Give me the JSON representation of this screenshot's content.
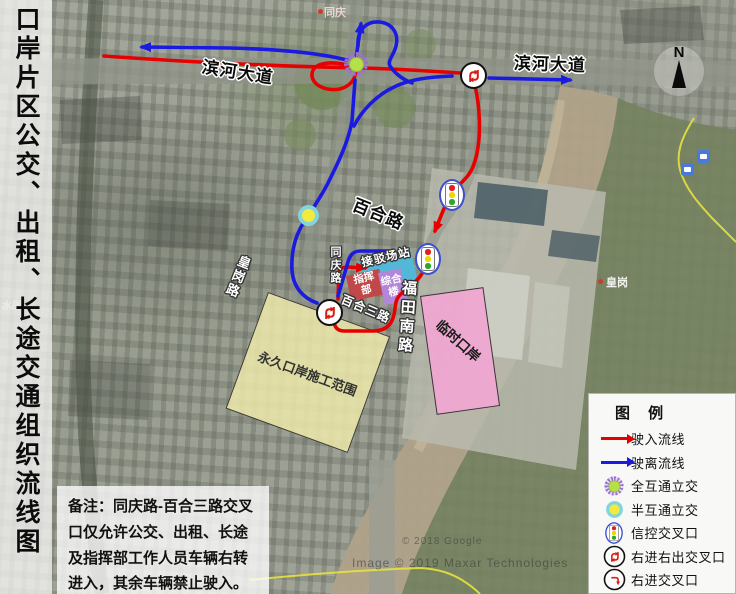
{
  "title": "口岸片区公交、出租、长途交通组织流线图",
  "note": "备注：同庆路-百合三路交叉口仅允许公交、出租、长途及指挥部工作人员车辆右转进入，其余车辆禁止驶入。",
  "compass": "N",
  "legend": {
    "title": "图 例",
    "items": [
      {
        "icon": "entry-flow-arrow",
        "label": "驶入流线"
      },
      {
        "icon": "exit-flow-arrow",
        "label": "驶离流线"
      },
      {
        "icon": "full-interchange",
        "label": "全互通立交"
      },
      {
        "icon": "half-interchange",
        "label": "半互通立交"
      },
      {
        "icon": "signal-intersection",
        "label": "信控交叉口"
      },
      {
        "icon": "right-in-right-out",
        "label": "右进右出交叉口"
      },
      {
        "icon": "right-in",
        "label": "右进交叉口"
      }
    ]
  },
  "roads": {
    "binhe_west": "滨河大道",
    "binhe_east": "滨河大道",
    "baihe": "百合路",
    "futian_south": "福田南路",
    "huanggang": "皇岗路",
    "tongqing": "同庆路",
    "baihe_3": "百合三路"
  },
  "areas": {
    "permanent_port": "永久口岸施工范围",
    "temporary_port": "临时口岸"
  },
  "buildings": {
    "transfer_station": "接驳场站",
    "headquarters": "指挥部",
    "complex_building": "综合楼"
  },
  "places": {
    "tongqing_village": "同庆",
    "huanggang_village": "皇岗",
    "shuiwei": "水围"
  },
  "watermarks": {
    "google": "© 2018 Google",
    "maxar": "Image © 2019 Maxar Technologies"
  },
  "colors": {
    "entry": "#e60000",
    "exit": "#1a1ae0",
    "permanent_fill": "#eee9ab",
    "temporary_fill": "#f2a7d3",
    "station_fill": "#53b8d8",
    "hq_fill": "#c04848",
    "complex_fill": "#b286d8"
  }
}
